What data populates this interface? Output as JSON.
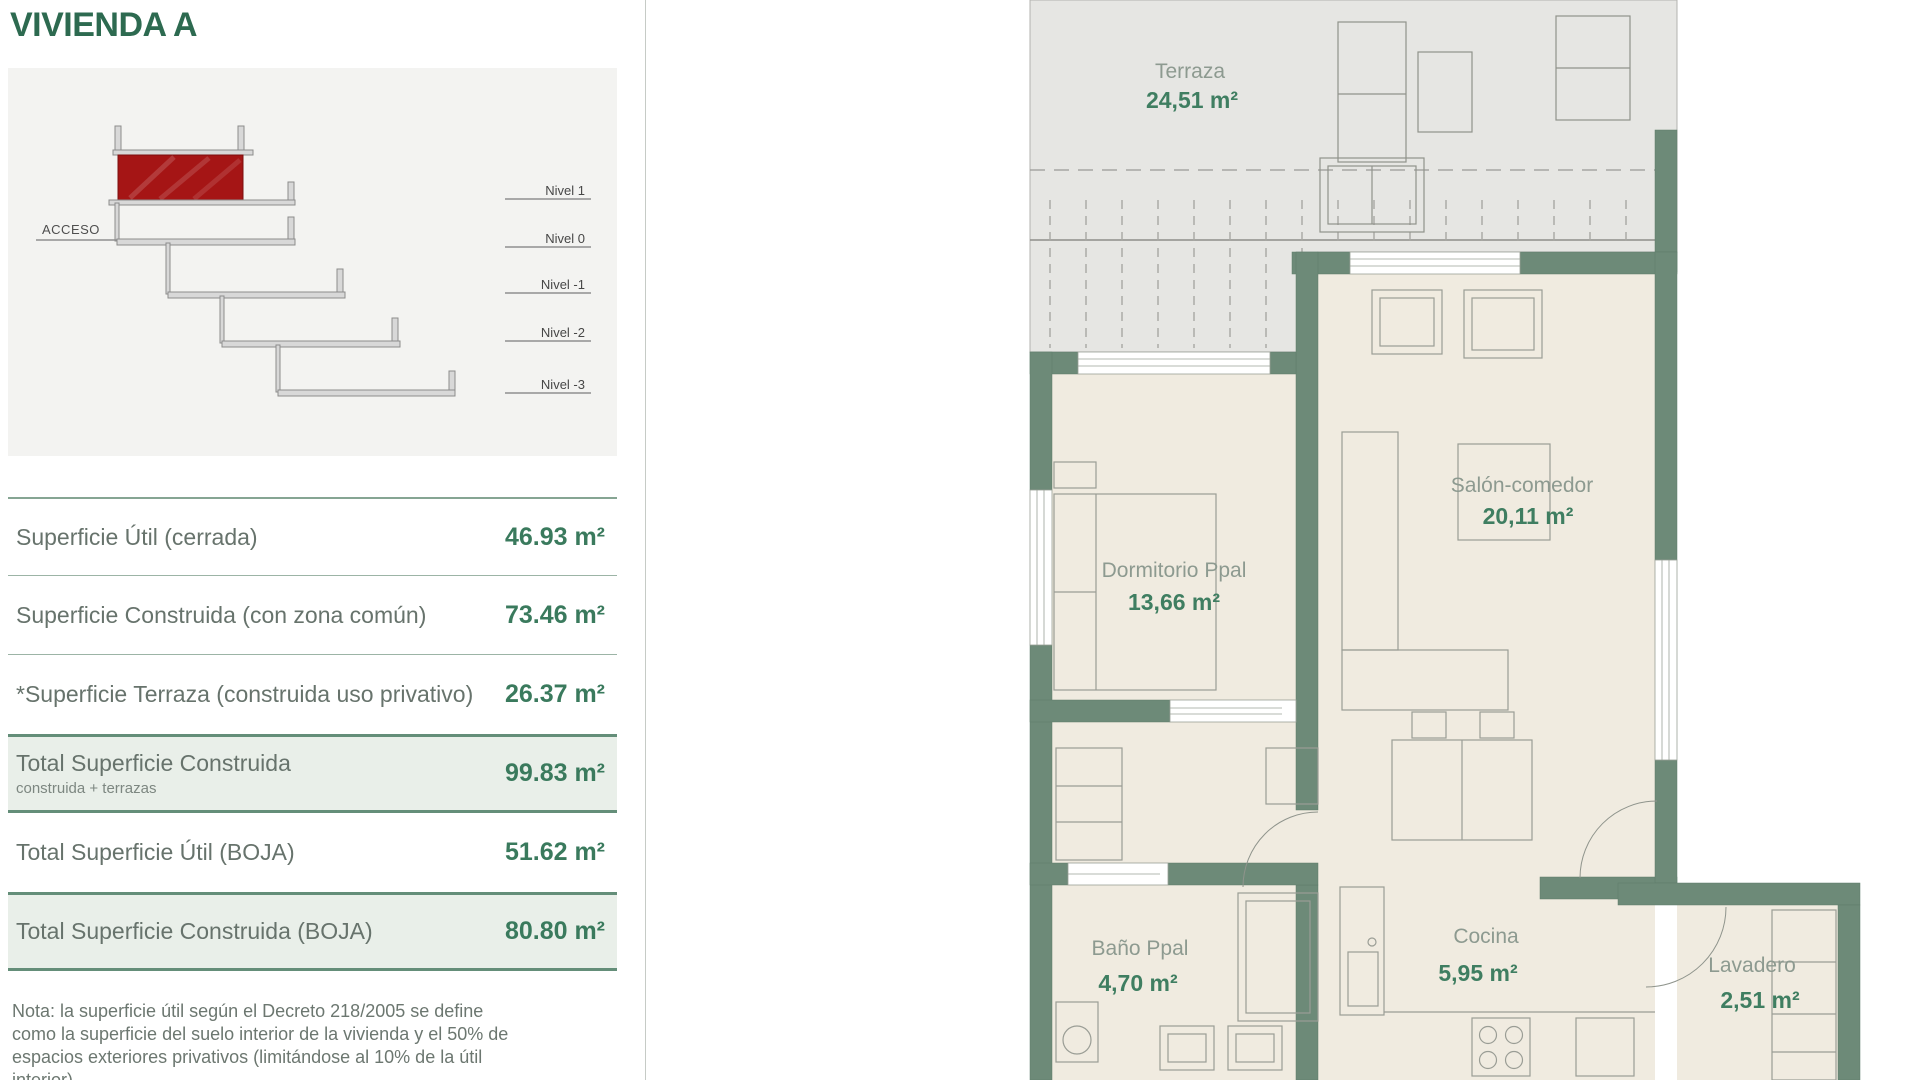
{
  "header": {
    "title": "VIVIENDA A"
  },
  "section_diagram": {
    "acceso_label": "ACCESO",
    "levels": [
      {
        "label": "Nivel 1"
      },
      {
        "label": "Nivel 0"
      },
      {
        "label": "Nivel -1"
      },
      {
        "label": "Nivel -2"
      },
      {
        "label": "Nivel -3"
      }
    ],
    "colors": {
      "highlight_red": "#a51515",
      "slab_gray": "#d8d8d8"
    }
  },
  "surface_table": {
    "rows": [
      {
        "label": "Superficie Útil (cerrada)",
        "value": "46.93 m²"
      },
      {
        "label": "Superficie Construida (con zona común)",
        "value": "73.46 m²"
      },
      {
        "label": "*Superficie Terraza (construida uso privativo)",
        "value": "26.37 m²"
      },
      {
        "label": "Total Superficie Construida",
        "sublabel": "construida + terrazas",
        "value": "99.83 m²"
      },
      {
        "label": "Total Superficie Útil (BOJA)",
        "value": "51.62 m²"
      },
      {
        "label": "Total Superficie Construida (BOJA)",
        "value": "80.80 m²"
      }
    ],
    "note": "Nota: la superficie útil según el Decreto 218/2005 se define como la superficie del suelo interior de la vivienda y el 50% de espacios exteriores privativos (limitándose al 10% de la útil interior)"
  },
  "floor_plan": {
    "rooms": [
      {
        "name": "Terraza",
        "area": "24,51 m²"
      },
      {
        "name": "Dormitorio Ppal",
        "area": "13,66 m²"
      },
      {
        "name": "Salón-comedor",
        "area": "20,11 m²"
      },
      {
        "name": "Baño Ppal",
        "area": "4,70 m²"
      },
      {
        "name": "Cocina",
        "area": "5,95 m²"
      },
      {
        "name": "Lavadero",
        "area": "2,51 m²"
      }
    ],
    "colors": {
      "wall_green": "#6d8a78",
      "floor_cream": "#f0ebe0",
      "terrace_gray": "#e6e6e3",
      "accent_green": "#3f7e61"
    }
  }
}
